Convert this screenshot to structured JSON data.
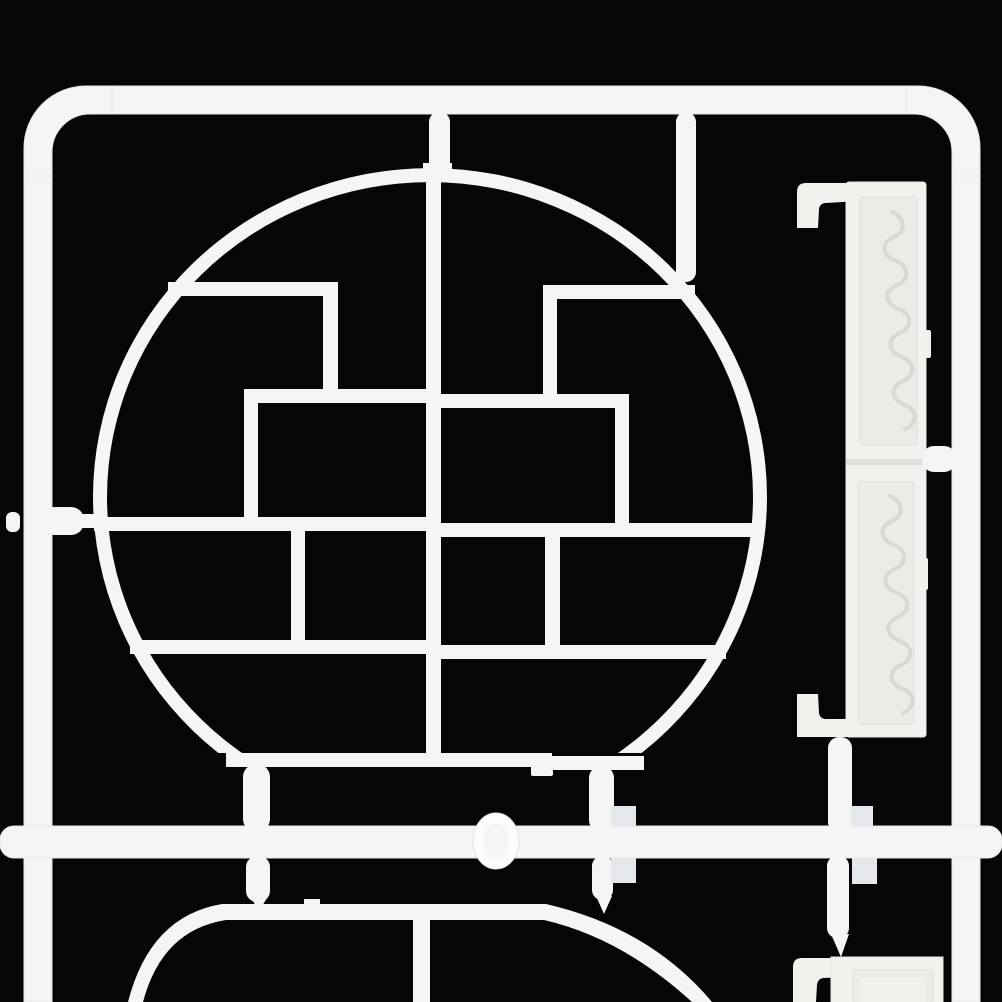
{
  "meta": {
    "alt": "White plastic model-kit sprue with round lattice shelf part, carved side strips and runner frame on black background",
    "width": 1002,
    "height": 1002
  },
  "palette": {
    "bg": "#060606",
    "plastic": "#f5f5f3",
    "plastic2": "#f1f1ee",
    "bright": "#fcfcfb",
    "shade": "#e6e6e2",
    "recess": "#ebebe7",
    "groove": "#dededa",
    "tab": "#e4e8ec",
    "scroll": "#d9d9d3"
  },
  "elements": [
    {
      "type": "rect",
      "name": "background",
      "fill": "bg",
      "x": 0,
      "y": 0,
      "w": 1002,
      "h": 1002
    },
    {
      "type": "rect",
      "name": "frame-top-rail",
      "fill": "plastic",
      "stroke": "shade",
      "x": 110,
      "y": 86,
      "w": 798,
      "h": 28,
      "rx": 3
    },
    {
      "type": "path",
      "name": "frame-corner-top-left",
      "fill": "plastic",
      "stroke": "shade",
      "d": "M24,178 L24,148 A62,62 0 0 1 86,86 L112,86 L112,114 L90,114 A38,38 0 0 0 52,152 L52,178 Z"
    },
    {
      "type": "path",
      "name": "frame-corner-top-right",
      "fill": "plastic",
      "stroke": "shade",
      "d": "M906,86 L918,86 A62,62 0 0 1 980,148 L980,178 L952,178 L952,152 A38,38 0 0 0 914,114 L906,114 Z"
    },
    {
      "type": "rect",
      "name": "frame-left-rail",
      "fill": "plastic",
      "stroke": "shade",
      "x": 24,
      "y": 176,
      "w": 28,
      "h": 826
    },
    {
      "type": "rect",
      "name": "frame-right-rail",
      "fill": "plastic",
      "stroke": "shade",
      "x": 952,
      "y": 176,
      "w": 28,
      "h": 826
    },
    {
      "type": "path",
      "name": "lattice-circle-ring",
      "fill": "plastic",
      "rule": "evenodd",
      "d": "M93,497 A337,329 0 0 1 767,497 A337,329 0 0 1 93,497 Z M107,497 A323,315 0 0 1 753,497 A323,315 0 0 1 107,497 Z"
    },
    {
      "type": "rect",
      "name": "ring-bottom-mask",
      "fill": "bg",
      "x": 88,
      "y": 753,
      "w": 680,
      "h": 76
    },
    {
      "type": "rect",
      "name": "circle-flat-bottom-left",
      "fill": "plastic",
      "x": 226,
      "y": 753,
      "w": 326,
      "h": 14
    },
    {
      "type": "rect",
      "name": "circle-flat-bottom-right",
      "fill": "plastic",
      "x": 548,
      "y": 756,
      "w": 96,
      "h": 14
    },
    {
      "type": "rect",
      "name": "circle-center-bar",
      "fill": "plastic",
      "x": 426,
      "y": 170,
      "w": 15,
      "h": 597
    },
    {
      "type": "rect",
      "name": "circle-center-bar-top-notch",
      "fill": "plastic",
      "x": 423,
      "y": 163,
      "w": 29,
      "h": 10
    },
    {
      "type": "rect",
      "name": "shelf-bar-top-left",
      "fill": "plastic",
      "x": 168,
      "y": 282,
      "w": 170,
      "h": 14
    },
    {
      "type": "rect",
      "name": "post-top-left",
      "fill": "plastic",
      "x": 323,
      "y": 294,
      "w": 15,
      "h": 97
    },
    {
      "type": "rect",
      "name": "shelf-bar-upper-left",
      "fill": "plastic",
      "x": 244,
      "y": 389,
      "w": 182,
      "h": 14
    },
    {
      "type": "rect",
      "name": "post-mid-left",
      "fill": "plastic",
      "x": 244,
      "y": 401,
      "w": 14,
      "h": 118
    },
    {
      "type": "rect",
      "name": "shelf-bar-middle-left",
      "fill": "plastic",
      "x": 94,
      "y": 517,
      "w": 332,
      "h": 14
    },
    {
      "type": "rect",
      "name": "post-lower-left",
      "fill": "plastic",
      "x": 291,
      "y": 529,
      "w": 14,
      "h": 113
    },
    {
      "type": "rect",
      "name": "shelf-bar-bottom-left",
      "fill": "plastic",
      "x": 130,
      "y": 640,
      "w": 296,
      "h": 14
    },
    {
      "type": "rect",
      "name": "shelf-bar-top-right",
      "fill": "plastic",
      "x": 543,
      "y": 285,
      "w": 152,
      "h": 14
    },
    {
      "type": "rect",
      "name": "post-top-right",
      "fill": "plastic",
      "x": 543,
      "y": 297,
      "w": 14,
      "h": 99
    },
    {
      "type": "rect",
      "name": "shelf-bar-upper-right",
      "fill": "plastic",
      "x": 441,
      "y": 394,
      "w": 188,
      "h": 14
    },
    {
      "type": "rect",
      "name": "post-mid-right",
      "fill": "plastic",
      "x": 615,
      "y": 406,
      "w": 14,
      "h": 119
    },
    {
      "type": "rect",
      "name": "shelf-bar-middle-right",
      "fill": "plastic",
      "x": 441,
      "y": 523,
      "w": 323,
      "h": 14
    },
    {
      "type": "rect",
      "name": "post-lower-right",
      "fill": "plastic",
      "x": 545,
      "y": 535,
      "w": 15,
      "h": 113
    },
    {
      "type": "rect",
      "name": "shelf-bar-bottom-right",
      "fill": "plastic",
      "x": 441,
      "y": 645,
      "w": 285,
      "h": 14
    },
    {
      "type": "rect",
      "name": "lower-panel-flat-top",
      "fill": "plastic",
      "x": 222,
      "y": 904,
      "w": 324,
      "h": 16
    },
    {
      "type": "rect",
      "name": "lower-panel-top-step",
      "fill": "plastic",
      "x": 304,
      "y": 899,
      "w": 16,
      "h": 9
    },
    {
      "type": "path",
      "name": "lower-panel-corner-left",
      "fill": "plastic",
      "d": "M222,904 Q150,916 128,1002 L143,1002 Q162,930 226,920 Z"
    },
    {
      "type": "path",
      "name": "lower-panel-corner-right",
      "fill": "plastic",
      "d": "M546,904 Q650,928 712,1002 L692,1002 Q622,938 544,920 Z"
    },
    {
      "type": "rect",
      "name": "lower-panel-center-bar",
      "fill": "plastic",
      "x": 413,
      "y": 918,
      "w": 17,
      "h": 84
    },
    {
      "type": "rect",
      "name": "side-strip-body",
      "fill": "plastic2",
      "stroke": "shade",
      "x": 846,
      "y": 182,
      "w": 80,
      "h": 555,
      "rx": 3
    },
    {
      "type": "rect",
      "name": "side-strip-recess-upper",
      "fill": "recess",
      "stroke": "groove",
      "x": 860,
      "y": 197,
      "w": 57,
      "h": 248,
      "rx": 3
    },
    {
      "type": "rect",
      "name": "side-strip-divider",
      "fill": "groove",
      "x": 846,
      "y": 459,
      "w": 80,
      "h": 6
    },
    {
      "type": "rect",
      "name": "side-strip-recess-lower",
      "fill": "recess",
      "stroke": "groove",
      "x": 858,
      "y": 482,
      "w": 56,
      "h": 242,
      "rx": 3
    },
    {
      "type": "path",
      "name": "scroll-ornament-upper",
      "fill": "none",
      "stroke": "scroll",
      "sw": 4,
      "cap": "round",
      "d": "M892,212 c13,6 15,19 2,25 c-14,6 -12,19 2,24 c13,5 14,18 1,24 c-14,6 -12,19 2,24 c13,5 14,18 1,24 c-14,6 -12,19 2,24 c13,5 14,18 1,24 c-14,6 -12,19 2,24 c13,5 13,18 0,24"
    },
    {
      "type": "path",
      "name": "scroll-ornament-lower",
      "fill": "none",
      "stroke": "scroll",
      "sw": 4,
      "cap": "round",
      "d": "M890,496 c13,6 15,19 2,25 c-14,6 -12,19 2,24 c13,5 14,18 1,24 c-14,6 -12,19 2,24 c13,5 14,18 1,24 c-14,6 -12,19 2,24 c13,5 14,18 1,24 c-14,6 -12,19 2,24 c13,5 13,18 0,24"
    },
    {
      "type": "rect",
      "name": "side-strip-tab-upper",
      "fill": "plastic2",
      "x": 919,
      "y": 330,
      "w": 12,
      "h": 28,
      "rx": 2
    },
    {
      "type": "rect",
      "name": "side-strip-tab-lower",
      "fill": "plastic2",
      "x": 914,
      "y": 558,
      "w": 14,
      "h": 32,
      "rx": 2
    },
    {
      "type": "path",
      "name": "side-strip-hook-top",
      "fill": "plastic2",
      "d": "M797,228 L797,192 Q797,183 806,183 L859,183 L859,201 L826,203 Q820,203 819,209 L818,228 Z"
    },
    {
      "type": "path",
      "name": "side-strip-hook-bottom",
      "fill": "plastic2",
      "d": "M797,737 L797,694 L818,694 L819,713 Q820,719 826,719 L859,719 L859,737 Z"
    },
    {
      "type": "path",
      "name": "corner-strip-hook",
      "fill": "plastic2",
      "d": "M793,1002 L793,967 Q793,958 802,958 L860,958 L860,976 L824,978 Q818,978 817,985 L816,1002 Z"
    },
    {
      "type": "rect",
      "name": "corner-strip-panel",
      "fill": "plastic2",
      "stroke": "shade",
      "x": 831,
      "y": 957,
      "w": 112,
      "h": 46
    },
    {
      "type": "rect",
      "name": "corner-strip-recess",
      "fill": "recess",
      "stroke": "groove",
      "x": 853,
      "y": 970,
      "w": 80,
      "h": 33,
      "rx": 3
    },
    {
      "type": "rect",
      "name": "corner-strip-plaque",
      "fill": "plastic2",
      "x": 861,
      "y": 978,
      "w": 64,
      "h": 25,
      "rx": 2
    },
    {
      "type": "rect",
      "name": "bottom-runner",
      "fill": "plastic",
      "stroke": "shade",
      "x": 0,
      "y": 826,
      "w": 1002,
      "h": 32,
      "rx": 14
    },
    {
      "type": "ellipse",
      "name": "runner-injection-knob",
      "fill": "bright",
      "stroke": "shade",
      "cx": 496,
      "cy": 841,
      "rx": 23,
      "ry": 28
    },
    {
      "type": "ellipse",
      "name": "runner-knob-highlight",
      "fill": "plastic",
      "cx": 496,
      "cy": 841,
      "rx": 13,
      "ry": 18
    },
    {
      "type": "rect",
      "name": "gate-top-center",
      "fill": "plastic",
      "x": 429,
      "y": 112,
      "w": 21,
      "h": 62,
      "rx": 10
    },
    {
      "type": "rect",
      "name": "gate-top-right",
      "fill": "plastic",
      "x": 676,
      "y": 112,
      "w": 20,
      "h": 170,
      "rx": 10
    },
    {
      "type": "rect",
      "name": "gate-left-neck",
      "fill": "plastic",
      "x": 76,
      "y": 514,
      "w": 28,
      "h": 14
    },
    {
      "type": "rect",
      "name": "gate-left-bulge",
      "fill": "plastic",
      "x": 42,
      "y": 507,
      "w": 42,
      "h": 28,
      "rx": 13
    },
    {
      "type": "rect",
      "name": "gate-left-rail-bump",
      "fill": "plastic",
      "x": 6,
      "y": 512,
      "w": 14,
      "h": 20,
      "rx": 6
    },
    {
      "type": "rect",
      "name": "gate-bottom-left",
      "fill": "plastic",
      "x": 243,
      "y": 764,
      "w": 27,
      "h": 68,
      "rx": 13
    },
    {
      "type": "rect",
      "name": "circle-bottom-foot",
      "fill": "plastic",
      "x": 531,
      "y": 764,
      "w": 22,
      "h": 12,
      "rx": 2
    },
    {
      "type": "rect",
      "name": "gate-bottom-right",
      "fill": "plastic",
      "x": 589,
      "y": 766,
      "w": 25,
      "h": 66,
      "rx": 12
    },
    {
      "type": "rect",
      "name": "gate-lower-panel-left",
      "fill": "plastic",
      "x": 246,
      "y": 856,
      "w": 24,
      "h": 46,
      "rx": 11
    },
    {
      "type": "path",
      "name": "gate-lower-panel-left-tip",
      "fill": "plastic",
      "d": "M251,898 L267,898 L259,911 Z"
    },
    {
      "type": "rect",
      "name": "gate-lower-panel-right",
      "fill": "plastic",
      "x": 592,
      "y": 856,
      "w": 21,
      "h": 44,
      "rx": 10
    },
    {
      "type": "path",
      "name": "gate-lower-panel-right-tip",
      "fill": "plastic",
      "d": "M596,896 L612,896 L604,914 Z"
    },
    {
      "type": "rect",
      "name": "gate-strip-bottom",
      "fill": "plastic",
      "x": 828,
      "y": 737,
      "w": 24,
      "h": 96,
      "rx": 11
    },
    {
      "type": "rect",
      "name": "gate-strip-to-rail",
      "fill": "plastic",
      "x": 922,
      "y": 446,
      "w": 34,
      "h": 26,
      "rx": 12
    },
    {
      "type": "rect",
      "name": "gate-corner-strip",
      "fill": "plastic",
      "x": 827,
      "y": 856,
      "w": 22,
      "h": 82,
      "rx": 10
    },
    {
      "type": "path",
      "name": "gate-corner-strip-tip",
      "fill": "plastic",
      "d": "M831,934 L849,934 L841,957 Z"
    },
    {
      "type": "rect",
      "name": "molding-tab-left-upper",
      "fill": "tab",
      "x": 611,
      "y": 806,
      "w": 25,
      "h": 21
    },
    {
      "type": "rect",
      "name": "molding-tab-left-lower",
      "fill": "tab",
      "x": 611,
      "y": 858,
      "w": 25,
      "h": 25
    },
    {
      "type": "rect",
      "name": "molding-tab-right-upper",
      "fill": "tab",
      "x": 851,
      "y": 806,
      "w": 22,
      "h": 21
    },
    {
      "type": "rect",
      "name": "molding-tab-right-lower",
      "fill": "tab",
      "x": 852,
      "y": 858,
      "w": 25,
      "h": 26
    }
  ]
}
